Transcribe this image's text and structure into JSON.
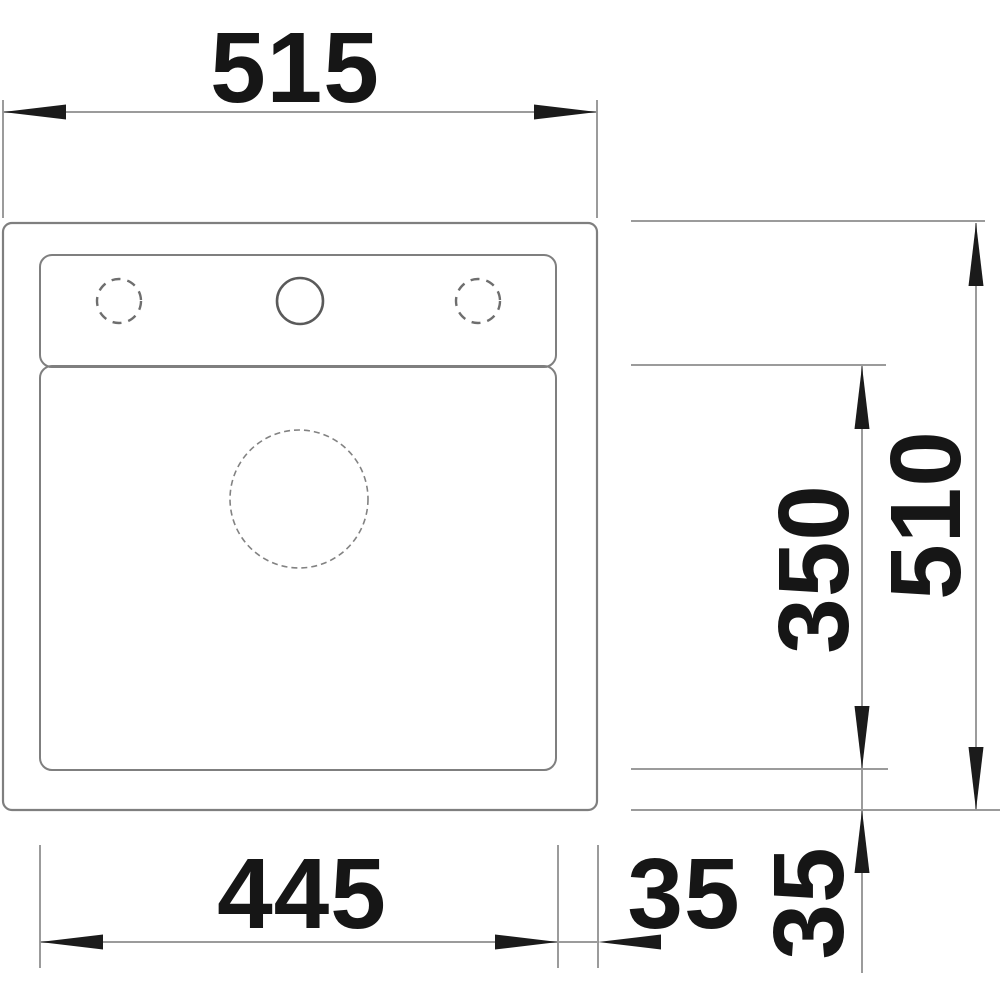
{
  "drawing": {
    "kind": "sink-installation-dimension-drawing",
    "view": "top"
  },
  "dimensions": {
    "overall_width": {
      "label": "515",
      "orientation": "horizontal",
      "position": "top"
    },
    "overall_depth": {
      "label": "510",
      "orientation": "vertical",
      "position": "right-outer"
    },
    "bowl_depth": {
      "label": "350",
      "orientation": "vertical",
      "position": "right-inner"
    },
    "bowl_width": {
      "label": "445",
      "orientation": "horizontal",
      "position": "bottom"
    },
    "offset_bottom": {
      "label": "35",
      "orientation": "horizontal",
      "position": "bottom-right"
    },
    "offset_right": {
      "label": "35",
      "orientation": "vertical",
      "position": "bottom-right-rotated"
    }
  },
  "features": {
    "faucet_hole_left": "dashed-optional-hole",
    "faucet_hole_center": "solid-hole",
    "faucet_hole_right": "dashed-optional-hole",
    "drain": "dashed-drain-circle"
  },
  "colors": {
    "background": "#ffffff",
    "sink_outline": "#7f7f7f",
    "dimension_line": "#9b9b9b",
    "arrow": "#1b1b1b",
    "label_text": "#161616"
  }
}
